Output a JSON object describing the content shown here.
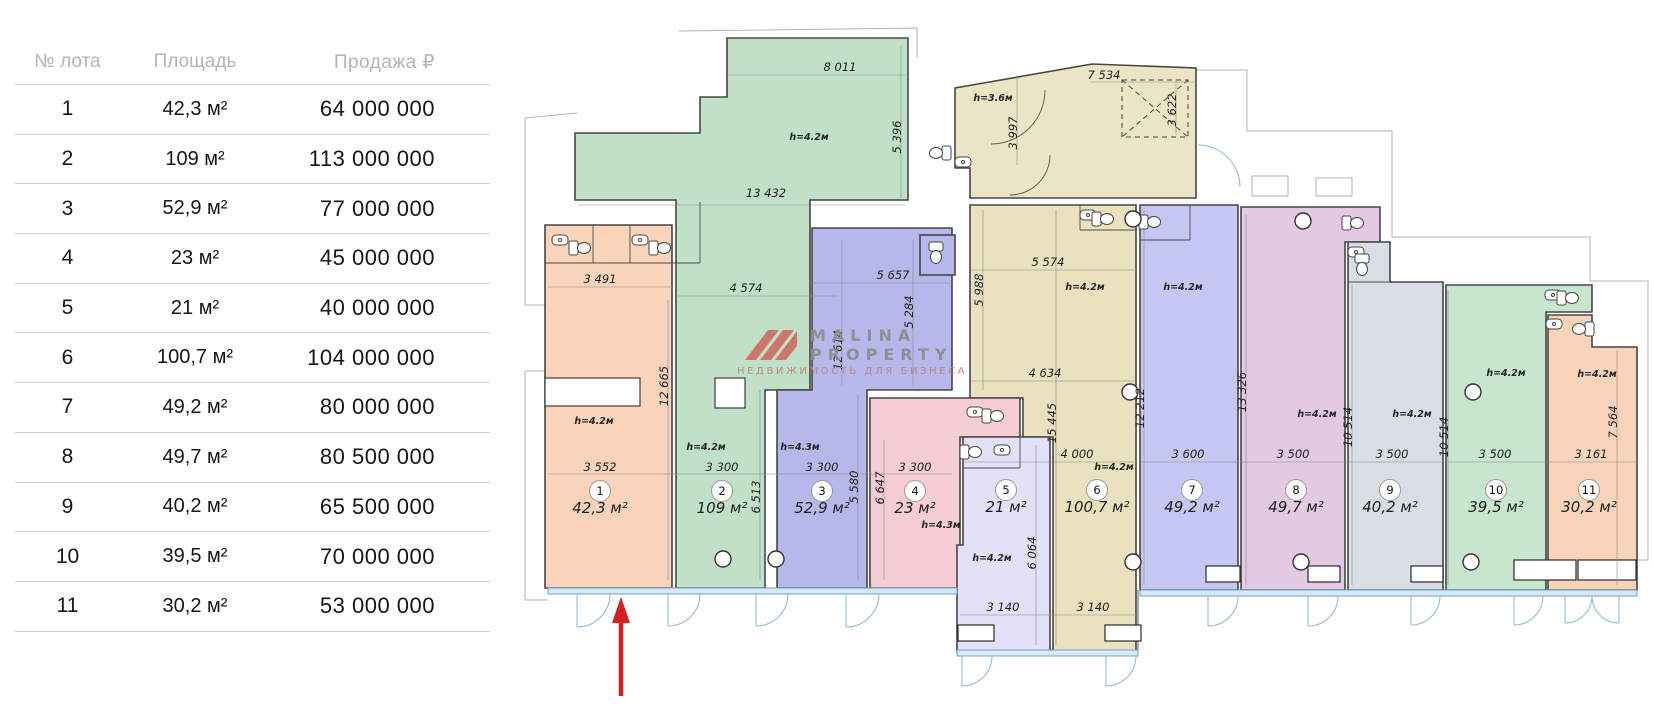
{
  "table": {
    "headers": {
      "lot": "№ лота",
      "area": "Площадь",
      "price": "Продажа ₽"
    },
    "rows": [
      {
        "lot": "1",
        "area": "42,3 м²",
        "price": "64 000 000"
      },
      {
        "lot": "2",
        "area": "109 м²",
        "price": "113 000 000"
      },
      {
        "lot": "3",
        "area": "52,9 м²",
        "price": "77 000 000"
      },
      {
        "lot": "4",
        "area": "23 м²",
        "price": "45 000 000"
      },
      {
        "lot": "5",
        "area": "21 м²",
        "price": "40 000 000"
      },
      {
        "lot": "6",
        "area": "100,7 м²",
        "price": "104 000 000"
      },
      {
        "lot": "7",
        "area": "49,2 м²",
        "price": "80 000 000"
      },
      {
        "lot": "8",
        "area": "49,7 м²",
        "price": "80 500 000"
      },
      {
        "lot": "9",
        "area": "40,2 м²",
        "price": "65 500 000"
      },
      {
        "lot": "10",
        "area": "39,5 м²",
        "price": "70 000 000"
      },
      {
        "lot": "11",
        "area": "30,2 м²",
        "price": "53 000 000"
      }
    ]
  },
  "watermark": {
    "brand_top": "MALINA",
    "brand_bottom": "PROPERTY",
    "tagline": "НЕДВИЖИМОСТЬ ДЛЯ БИЗНЕСА",
    "logo_color": "#cf6f66"
  },
  "plan": {
    "entry_color": "#ece4c3",
    "glazing_color": "#d7e9f6",
    "arrow_color": "#db1d1d",
    "units": [
      {
        "num": "1",
        "area": "42,3 м²",
        "h": "h=4.2м",
        "wdim": "3 552",
        "color": "#f9d3b8"
      },
      {
        "num": "2",
        "area": "109 м²",
        "h": "h=4.2м",
        "wdim": "3 300",
        "color": "#bee0c5"
      },
      {
        "num": "3",
        "area": "52,9 м²",
        "h": "h=4.3м",
        "wdim": "3 300",
        "color": "#b4b5ea"
      },
      {
        "num": "4",
        "area": "23 м²",
        "h": "h=4.3м",
        "wdim": "3 300",
        "color": "#f6cbd3"
      },
      {
        "num": "5",
        "area": "21 м²",
        "h": "h=4.2м",
        "wdim": "3 140",
        "color": "#e0e0f8"
      },
      {
        "num": "6",
        "area": "100,7 м²",
        "h": "h=4.2м",
        "wdim": "4 000",
        "color": "#eae1bd"
      },
      {
        "num": "7",
        "area": "49,2 м²",
        "h": "h=4.2м",
        "wdim": "3 600",
        "color": "#c3c4f2"
      },
      {
        "num": "8",
        "area": "49,7 м²",
        "h": "h=4.2м",
        "wdim": "3 500",
        "color": "#e1c7e3"
      },
      {
        "num": "9",
        "area": "40,2 м²",
        "h": "h=4.2м",
        "wdim": "3 500",
        "color": "#d8dde4"
      },
      {
        "num": "10",
        "area": "39,5 м²",
        "h": "h=4.2м",
        "wdim": "3 500",
        "color": "#c4e5cb"
      },
      {
        "num": "11",
        "area": "30,2 м²",
        "h": "h=4.2м",
        "wdim": "3 161",
        "color": "#f9d3b8"
      }
    ],
    "dims": {
      "hall_top": "8 011",
      "hall_right": "5 396",
      "hall_bottom": "13 432",
      "hall_h": "h=4.2м",
      "entry_top": "7 534",
      "entry_h": "h=3.6м",
      "entry_v1": "3 997",
      "entry_v2": "3 622",
      "u1_top": "3 491",
      "u1_v": "12 665",
      "u2_top": "4 574",
      "u2_v": "6 513",
      "u3_top": "5 657",
      "u3_v1": "5 284",
      "u3_v2": "12 614",
      "u3_v3": "5 580",
      "u4_v": "6 647",
      "u5_v": "6 064",
      "u5_bottom": "3 140",
      "u6_v1": "5 988",
      "u6_top": "5 574",
      "u6_mid": "4 634",
      "u6_v2": "15 445",
      "u6_h2": "h=4.2м",
      "u6_bottom": "3 140",
      "u7_v": "12 212",
      "u8_v": "13 326",
      "u9_v": "10 514",
      "u10_v": "10 514",
      "u11_v": "7 564"
    }
  }
}
